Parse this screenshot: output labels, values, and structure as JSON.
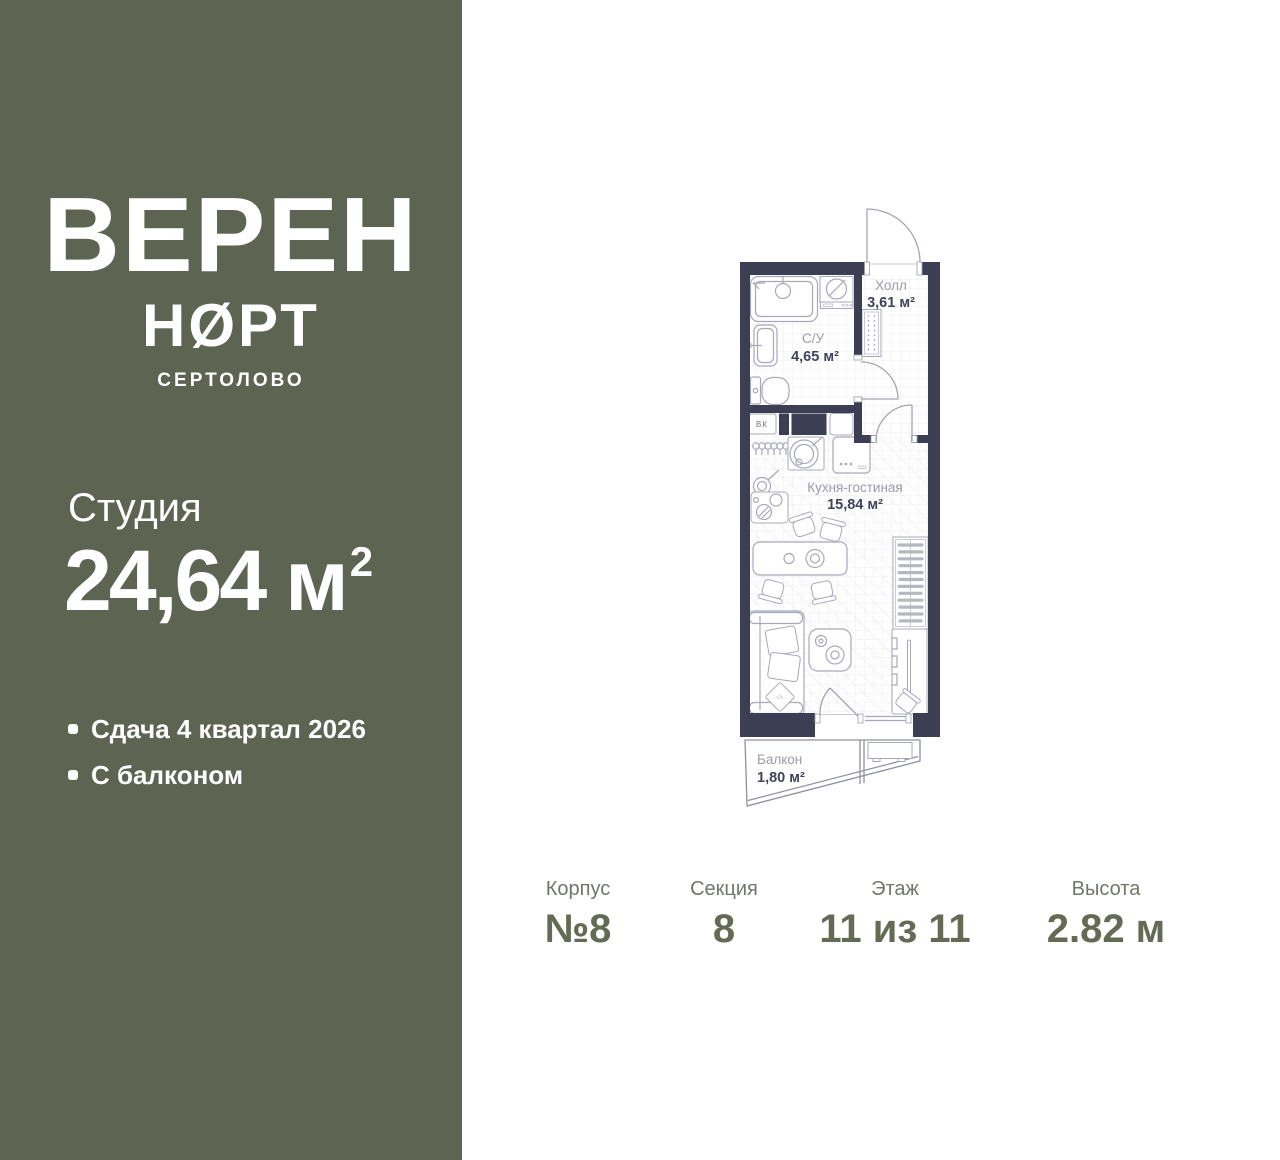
{
  "brand": {
    "name_top": "ВЕРЕН",
    "name_bottom": "НØРТ",
    "city": "СЕРТОЛОВО"
  },
  "unit": {
    "type": "Студия",
    "area_value": "24,64",
    "area_unit": "м",
    "area_superscript": "2"
  },
  "features": [
    {
      "text": "Сдача 4 квартал 2026"
    },
    {
      "text": "С балконом"
    }
  ],
  "floorplan": {
    "rooms": [
      {
        "name": "Холл",
        "area": "3,61 м²"
      },
      {
        "name": "С/У",
        "area": "4,65 м²"
      },
      {
        "name": "Кухня-гостиная",
        "area": "15,84 м²"
      },
      {
        "name": "Балкон",
        "area": "1,80 м²"
      }
    ],
    "marks": {
      "duct": "ВК"
    }
  },
  "details": [
    {
      "label": "Корпус",
      "value": "№8"
    },
    {
      "label": "Секция",
      "value": "8"
    },
    {
      "label": "Этаж",
      "value": "11 из 11"
    },
    {
      "label": "Высота",
      "value": "2.82 м"
    }
  ],
  "colors": {
    "sidebar": "#5E6452",
    "wall": "#3C3E54",
    "detail_label": "#71766B",
    "detail_value": "#656A54",
    "plan_room_label": "#9C9CAA",
    "plan_room_value": "#42435A"
  }
}
